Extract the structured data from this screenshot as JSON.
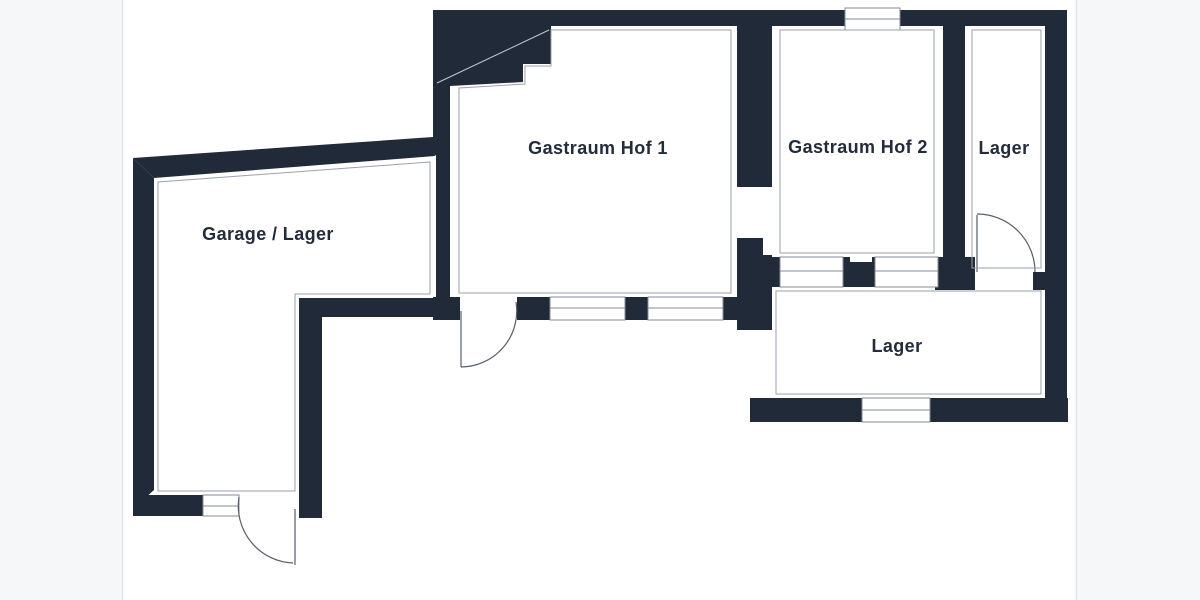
{
  "plan": {
    "type": "floorplan",
    "rooms": [
      {
        "id": "garage",
        "label": "Garage / Lager"
      },
      {
        "id": "gastraum-hof-1",
        "label": "Gastraum Hof 1"
      },
      {
        "id": "gastraum-hof-2",
        "label": "Gastraum Hof 2"
      },
      {
        "id": "lager-top",
        "label": "Lager"
      },
      {
        "id": "lager-bottom",
        "label": "Lager"
      }
    ],
    "counts": {
      "windows": 7,
      "doors": 3,
      "open-passages": 1
    },
    "colors": {
      "wall": "#212a38",
      "label": "#232c3b",
      "outline": "#9aa0ac",
      "frame": "#dfe2e7",
      "background": "#f6f7f9",
      "floor": "#ffffff"
    }
  }
}
